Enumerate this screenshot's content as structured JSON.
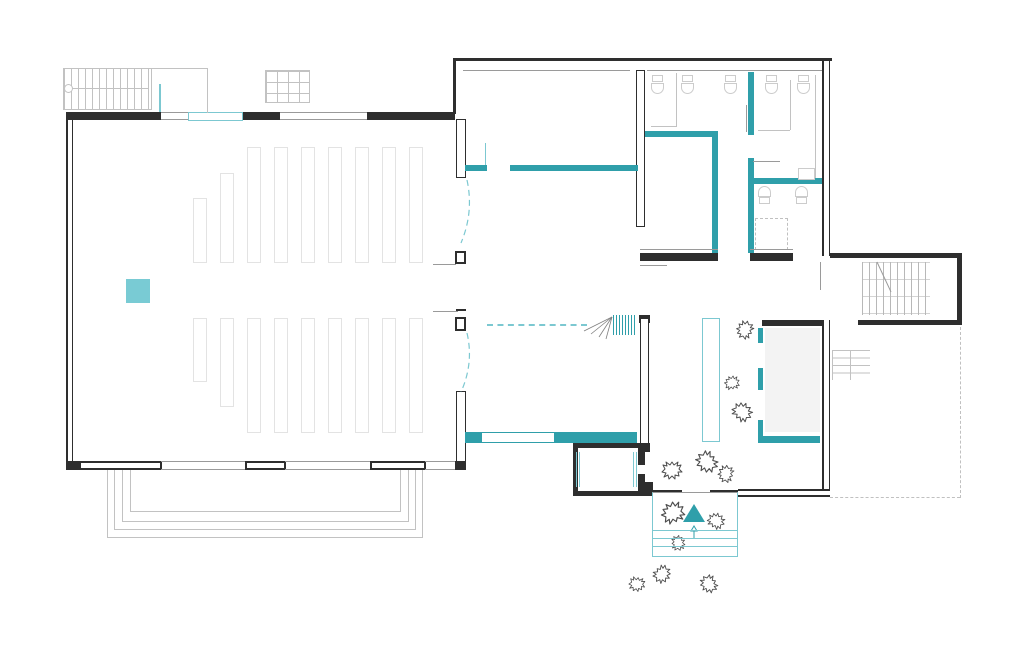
{
  "meta": {
    "kind": "architectural-floor-plan",
    "has_text": false,
    "canvas": {
      "width": 1024,
      "height": 647
    }
  },
  "colors": {
    "wall": "#2e2e2e",
    "line": "#9a9a9a",
    "line_light": "#c2c2c2",
    "faint": "#dddddd",
    "pew": "#e3e3e3",
    "fixture": "#cccccc",
    "teal": "#2f9faa",
    "teal_light": "#7cc8d1",
    "teal_fill": "#79cbd4",
    "stage": "#f3f3f3",
    "dash": "#c0c0c0",
    "bush": "#4d4d4d"
  },
  "plan": {
    "pews": {
      "x_start": 193,
      "spacing": 27,
      "width": 14,
      "upper_tops": [
        198,
        173,
        147,
        147,
        147,
        147,
        147,
        147,
        147
      ],
      "upper_bottom": 263,
      "lower_top": 318,
      "lower_bottoms": [
        382,
        407,
        433,
        433,
        433,
        433,
        433,
        433,
        433
      ]
    },
    "terrace_steps": [
      [
        107,
        470,
        316,
        68
      ],
      [
        114,
        470,
        302,
        60
      ],
      [
        122,
        470,
        287,
        52
      ],
      [
        130,
        470,
        271,
        42
      ]
    ],
    "porch_step_lines_y": [
      530,
      538,
      546
    ],
    "toilets_top_x": [
      651,
      681,
      724,
      765,
      797
    ],
    "toilets_bottom": [
      [
        758,
        186
      ],
      [
        795,
        186
      ]
    ],
    "sinks": [
      [
        798,
        168,
        17,
        12
      ]
    ],
    "bushes": [
      [
        672,
        470,
        1
      ],
      [
        707,
        462,
        1.1
      ],
      [
        726,
        474,
        0.85
      ],
      [
        673,
        513,
        1.15
      ],
      [
        716,
        521,
        0.85
      ],
      [
        678,
        543,
        0.75
      ],
      [
        662,
        574,
        0.9
      ],
      [
        637,
        584,
        0.8
      ],
      [
        709,
        584,
        0.9
      ],
      [
        745,
        330,
        0.9
      ],
      [
        732,
        383,
        0.75
      ],
      [
        742,
        412,
        1
      ]
    ]
  }
}
